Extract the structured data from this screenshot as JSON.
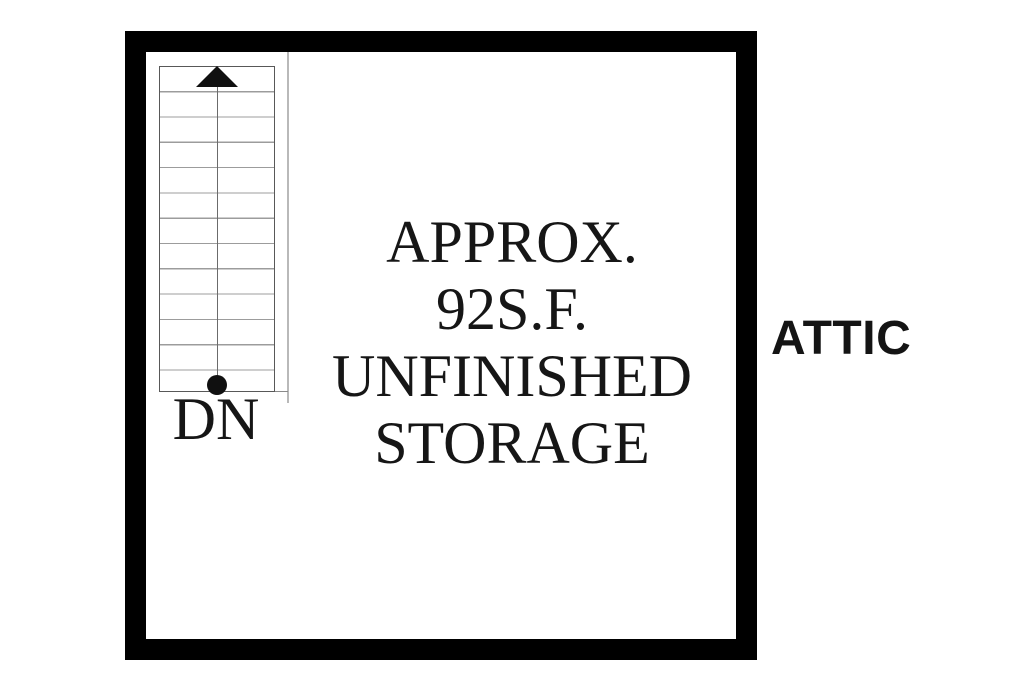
{
  "floor_plan": {
    "room_label": "ATTIC",
    "area_text": [
      "APPROX.",
      "92S.F.",
      "UNFINISHED",
      "STORAGE"
    ],
    "stairs": {
      "label": "DN",
      "tread_rows": 13
    },
    "colors": {
      "wall": "#000000",
      "ink": "#161616",
      "stair_outline": "#585858",
      "tread_line": "#9c9c9c",
      "guide_line": "#6b6b6b",
      "partition_line": "#b9b9b9"
    }
  }
}
